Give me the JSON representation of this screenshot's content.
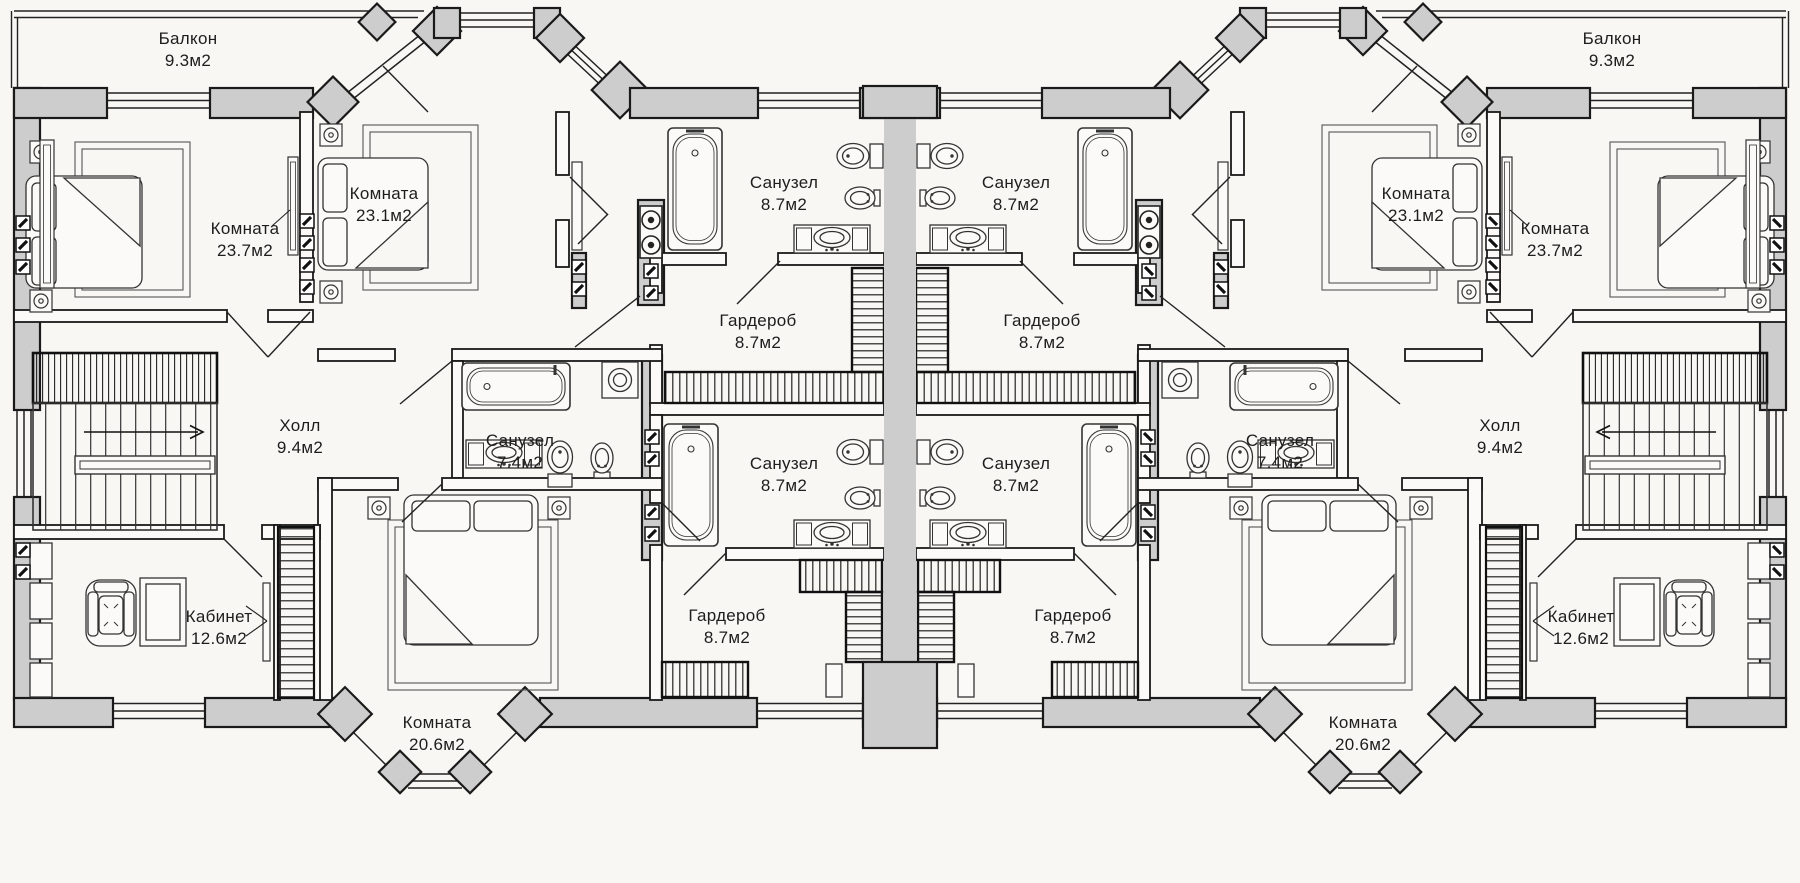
{
  "plan": {
    "title": "Second floor plan of a mirrored duplex house",
    "background_color": "#f8f7f4",
    "wall_fill_color": "#cdcdcd",
    "line_color": "#1a1a1a",
    "area_unit": "м2",
    "units": [
      {
        "side": "left",
        "rooms": [
          "Балкон 9.3м2",
          "Комната 23.7м2",
          "Комната 23.1м2",
          "Санузел 8.7м2",
          "Гардероб 8.7м2",
          "Холл 9.4м2",
          "Санузел 7.4м2",
          "Санузел 8.7м2",
          "Гардероб 8.7м2",
          "Кабинет 12.6м2",
          "Комната 20.6м2"
        ]
      },
      {
        "side": "right",
        "rooms": [
          "Балкон 9.3м2",
          "Комната 23.7м2",
          "Комната 23.1м2",
          "Санузел 8.7м2",
          "Гардероб 8.7м2",
          "Холл 9.4м2",
          "Санузел 7.4м2",
          "Санузел 8.7м2",
          "Гардероб 8.7м2",
          "Кабинет 12.6м2",
          "Комната 20.6м2"
        ]
      }
    ],
    "labels": [
      {
        "key": "balcony-left",
        "name": "Балкон",
        "area": "9.3м2"
      },
      {
        "key": "room-23-7-left",
        "name": "Комната",
        "area": "23.7м2"
      },
      {
        "key": "room-23-1-left",
        "name": "Комната",
        "area": "23.1м2"
      },
      {
        "key": "bathroom-top-left",
        "name": "Санузел",
        "area": "8.7м2"
      },
      {
        "key": "wardrobe-top-left",
        "name": "Гардероб",
        "area": "8.7м2"
      },
      {
        "key": "hall-left",
        "name": "Холл",
        "area": "9.4м2"
      },
      {
        "key": "bathroom-74-left",
        "name": "Санузел",
        "area": "7.4м2"
      },
      {
        "key": "bathroom-mid-left",
        "name": "Санузел",
        "area": "8.7м2"
      },
      {
        "key": "wardrobe-bottom-left",
        "name": "Гардероб",
        "area": "8.7м2"
      },
      {
        "key": "office-left",
        "name": "Кабинет",
        "area": "12.6м2"
      },
      {
        "key": "room-20-6-left",
        "name": "Комната",
        "area": "20.6м2"
      },
      {
        "key": "balcony-right",
        "name": "Балкон",
        "area": "9.3м2"
      },
      {
        "key": "room-23-7-right",
        "name": "Комната",
        "area": "23.7м2"
      },
      {
        "key": "room-23-1-right",
        "name": "Комната",
        "area": "23.1м2"
      },
      {
        "key": "bathroom-top-right",
        "name": "Санузел",
        "area": "8.7м2"
      },
      {
        "key": "wardrobe-top-right",
        "name": "Гардероб",
        "area": "8.7м2"
      },
      {
        "key": "hall-right",
        "name": "Холл",
        "area": "9.4м2"
      },
      {
        "key": "bathroom-74-right",
        "name": "Санузел",
        "area": "7.4м2"
      },
      {
        "key": "bathroom-mid-right",
        "name": "Санузел",
        "area": "8.7м2"
      },
      {
        "key": "wardrobe-bottom-right",
        "name": "Гардероб",
        "area": "8.7м2"
      },
      {
        "key": "office-right",
        "name": "Кабинет",
        "area": "12.6м2"
      },
      {
        "key": "room-20-6-right",
        "name": "Комната",
        "area": "20.6м2"
      }
    ]
  }
}
